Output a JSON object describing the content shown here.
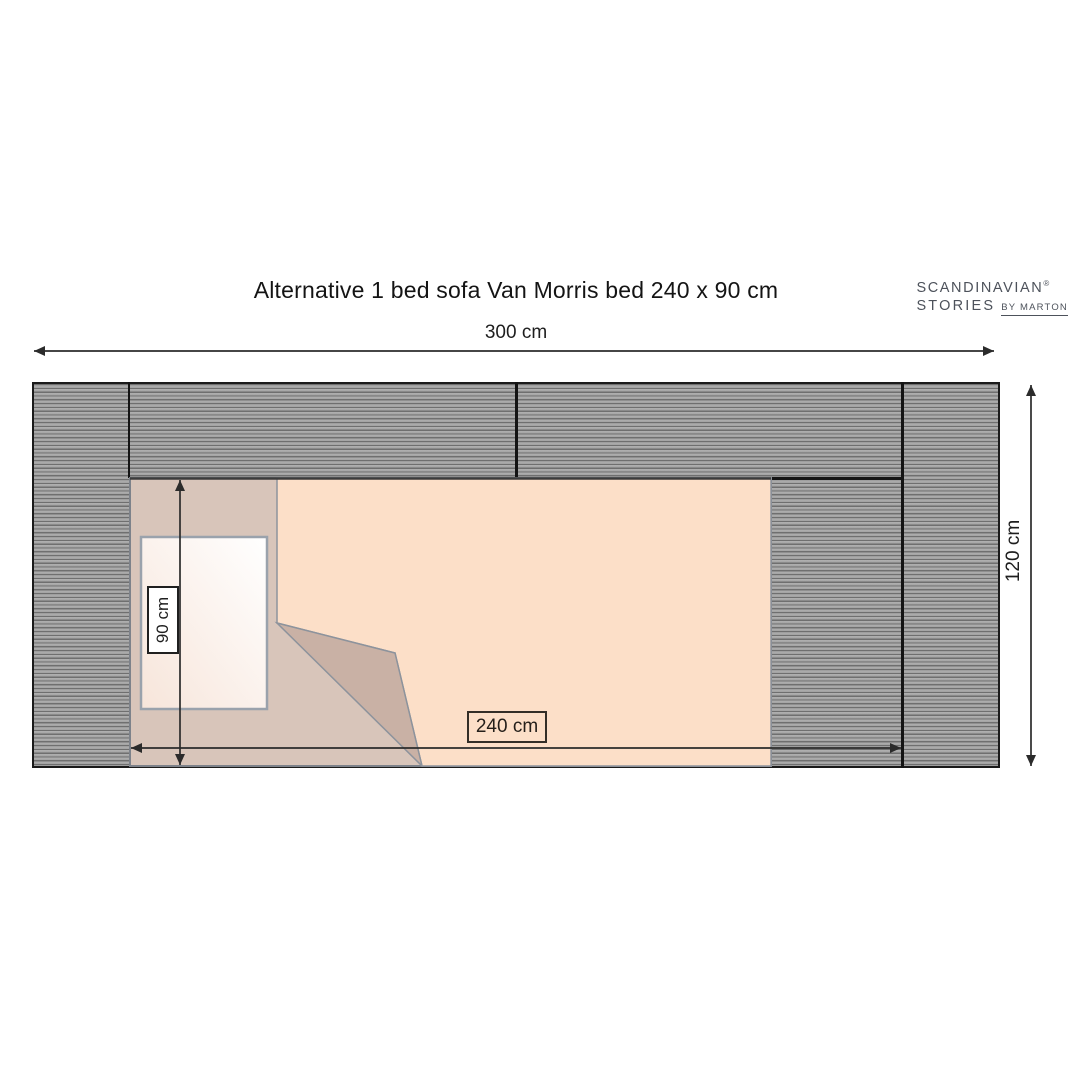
{
  "header": {
    "title": "Alternative 1 bed sofa Van Morris bed 240 x 90 cm",
    "logo": {
      "line1": "SCANDINAVIAN",
      "registered_mark": "®",
      "line2": "STORIES",
      "byline": "BY MARTON"
    }
  },
  "diagram": {
    "type": "furniture-floor-plan",
    "subject": "Van Morris sofa bed, top view with bed unfolded",
    "dimensions": {
      "total_width": "300 cm",
      "total_depth": "120 cm",
      "bed_length": "240 cm",
      "bed_width": "90 cm"
    },
    "colors": {
      "sofa_hatch_dark": "#6f6f6f",
      "sofa_hatch_light": "#b1b1b1",
      "sofa_outline": "#1b1b1b",
      "mattress": "#d8c5ba",
      "blanket": "#fcdfc8",
      "blanket_fold": "#c9b1a5",
      "pillow": "#ffffff",
      "pillow_border": "#9aa2ac",
      "dimension_lines": "#2b2b2b",
      "label_90_bg": "#ffffff",
      "label_240_bg": "#fcdfc8",
      "logo_text": "#4d525b"
    }
  }
}
